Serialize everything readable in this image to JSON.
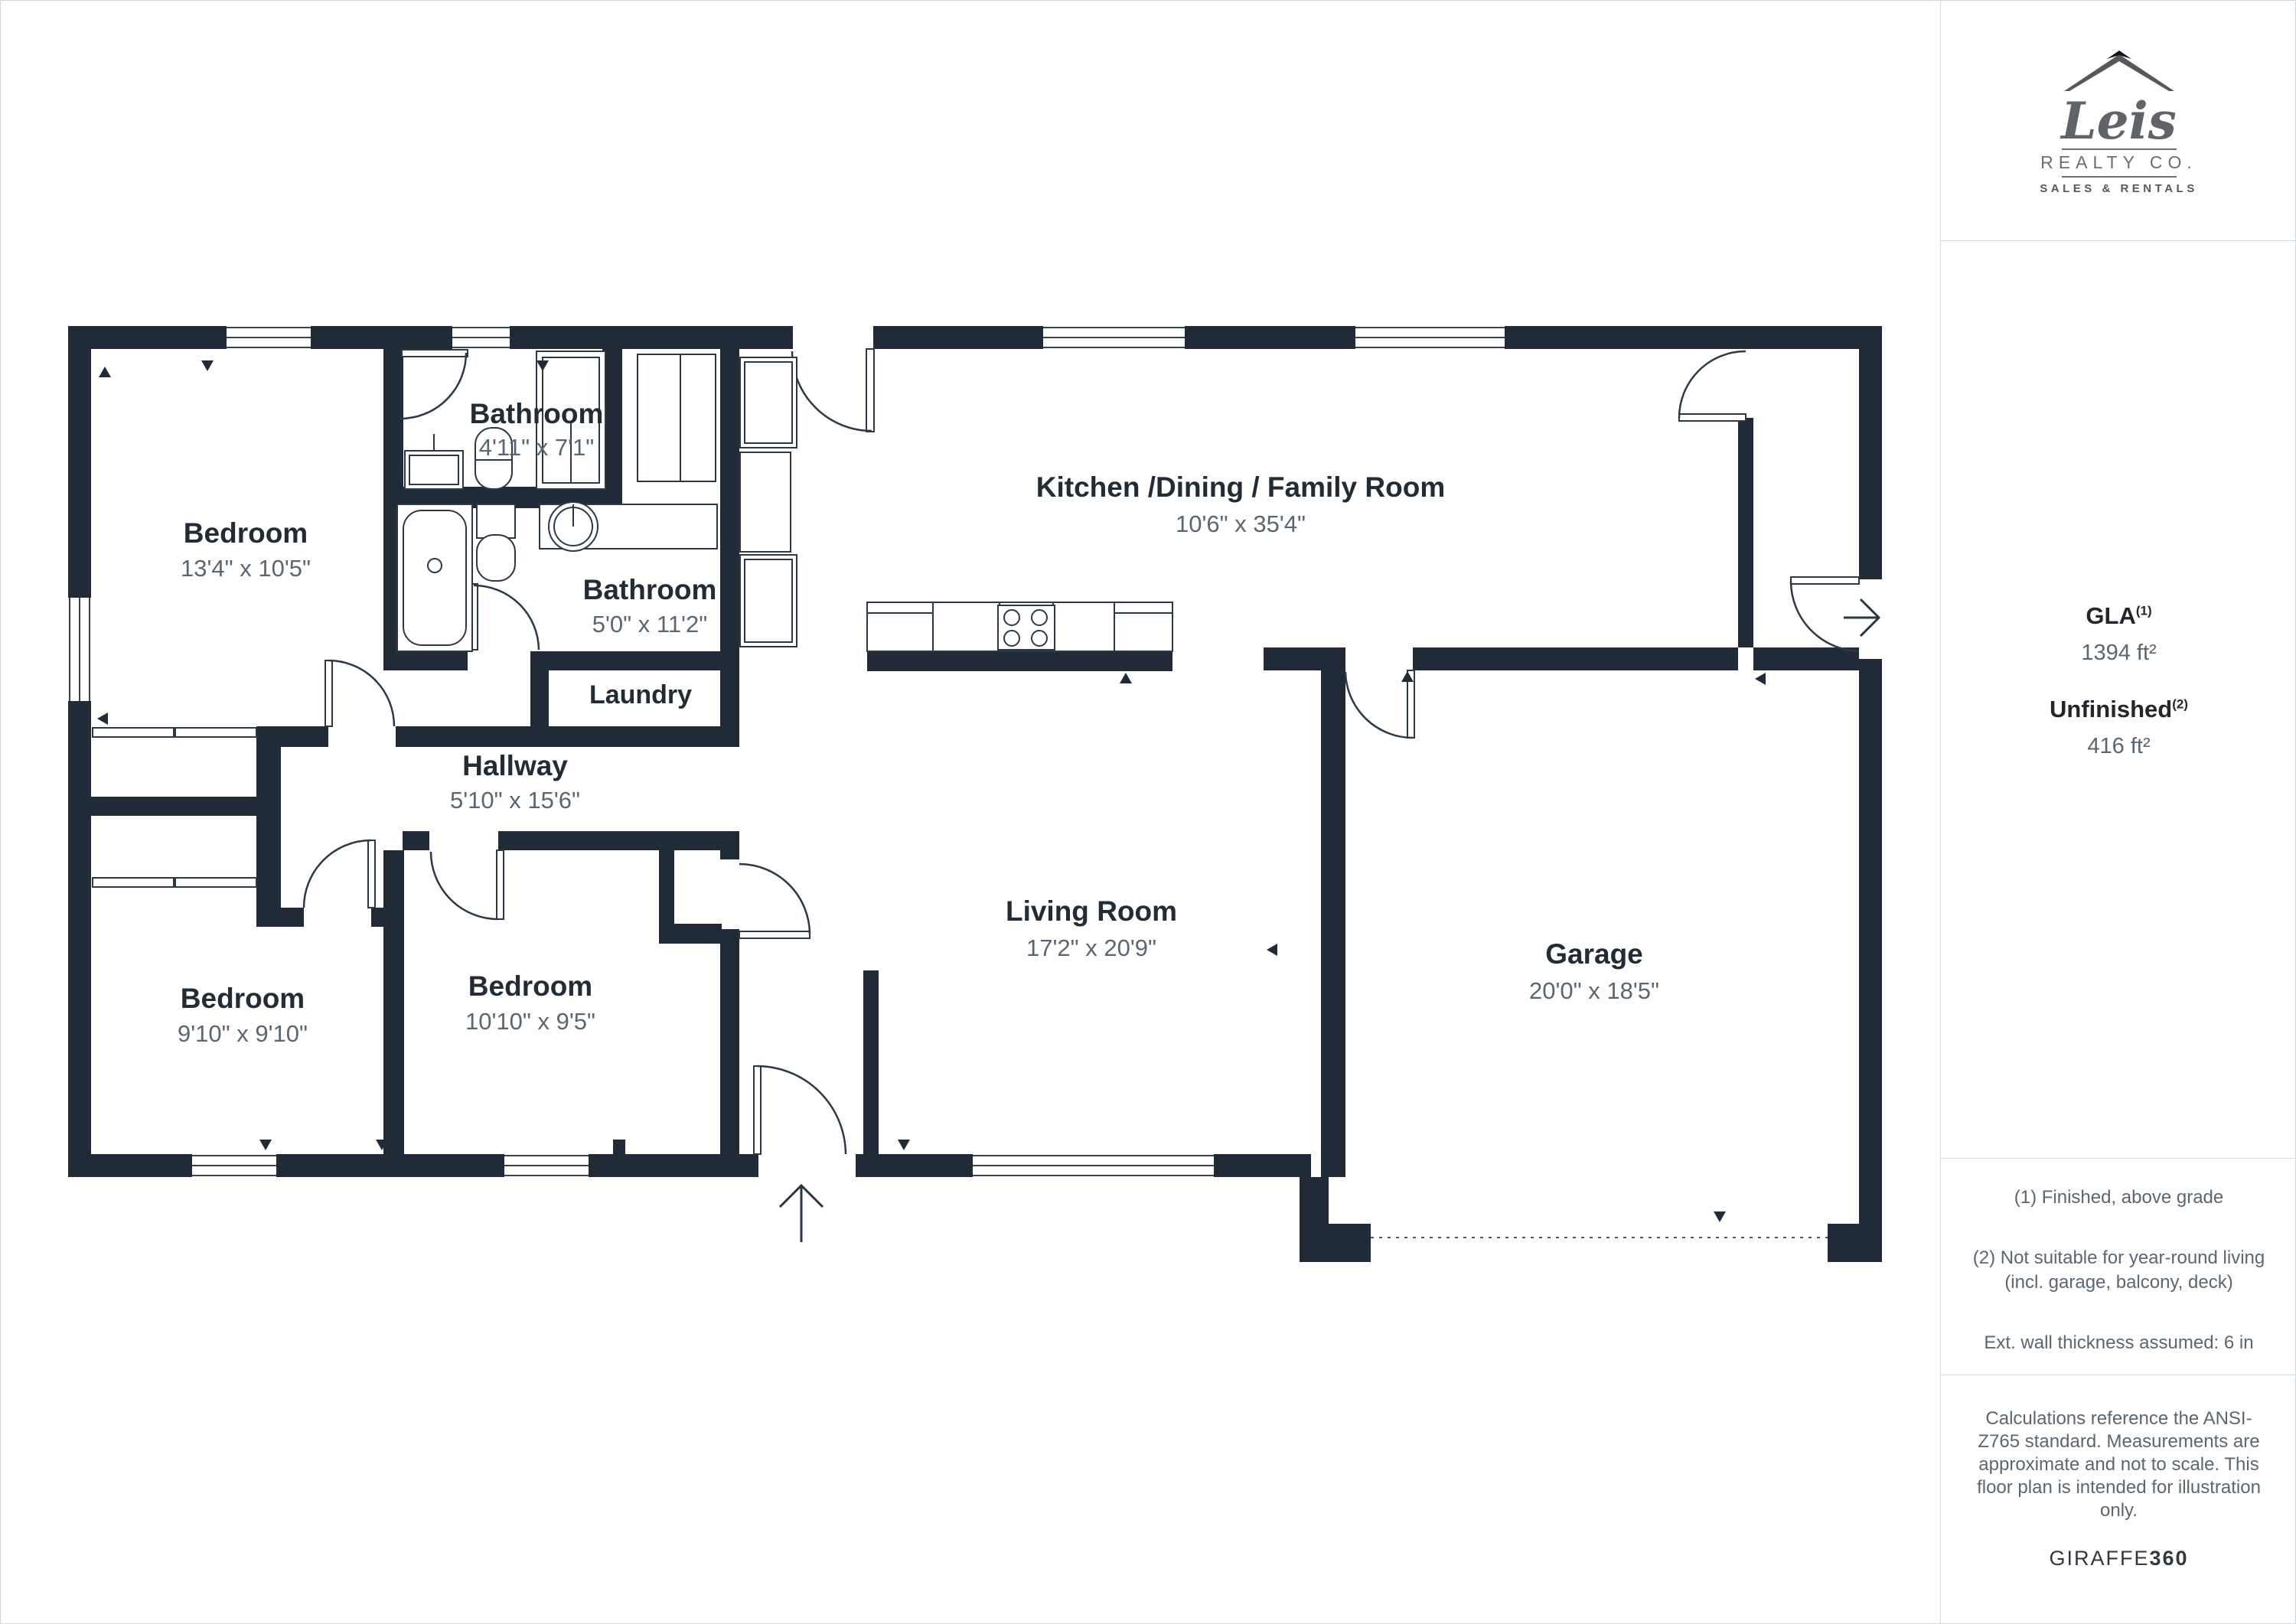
{
  "colors": {
    "wall": "#212b37",
    "text_dark": "#232c35",
    "text_gray": "#5b6670",
    "border": "#d8dbde",
    "logo_gray": "#606468"
  },
  "rooms": [
    {
      "id": "bedroom-top-left",
      "name": "Bedroom",
      "dims": "13'4\" x 10'5\""
    },
    {
      "id": "bathroom-top",
      "name": "Bathroom",
      "dims": "4'11\" x 7'1\""
    },
    {
      "id": "bathroom-main",
      "name": "Bathroom",
      "dims": "5'0\" x 11'2\""
    },
    {
      "id": "laundry",
      "name": "Laundry",
      "dims": ""
    },
    {
      "id": "hallway",
      "name": "Hallway",
      "dims": "5'10\" x 15'6\""
    },
    {
      "id": "bedroom-bottom-left",
      "name": "Bedroom",
      "dims": "9'10\" x 9'10\""
    },
    {
      "id": "bedroom-bottom-mid",
      "name": "Bedroom",
      "dims": "10'10\" x 9'5\""
    },
    {
      "id": "kitchen",
      "name": "Kitchen /Dining / Family Room",
      "dims": "10'6\" x 35'4\""
    },
    {
      "id": "living-room",
      "name": "Living Room",
      "dims": "17'2\" x 20'9\""
    },
    {
      "id": "garage",
      "name": "Garage",
      "dims": "20'0\" x 18'5\""
    }
  ],
  "sidebar": {
    "logo": {
      "name": "Leis",
      "sub": "REALTY CO.",
      "tag": "SALES & RENTALS"
    },
    "gla": {
      "label": "GLA",
      "sup": "(1)",
      "value": "1394 ft²"
    },
    "unfinished": {
      "label": "Unfinished",
      "sup": "(2)",
      "value": "416 ft²"
    },
    "notes": [
      "(1) Finished, above grade",
      "(2) Not suitable for year-round living (incl. garage, balcony, deck)",
      "Ext. wall thickness assumed: 6 in"
    ],
    "disclaimer": "Calculations reference the ANSI-Z765 standard. Measurements are approximate and not to scale. This floor plan is intended for illustration only.",
    "brand": {
      "giraffe": "GIRAFFE",
      "num": "360"
    }
  }
}
